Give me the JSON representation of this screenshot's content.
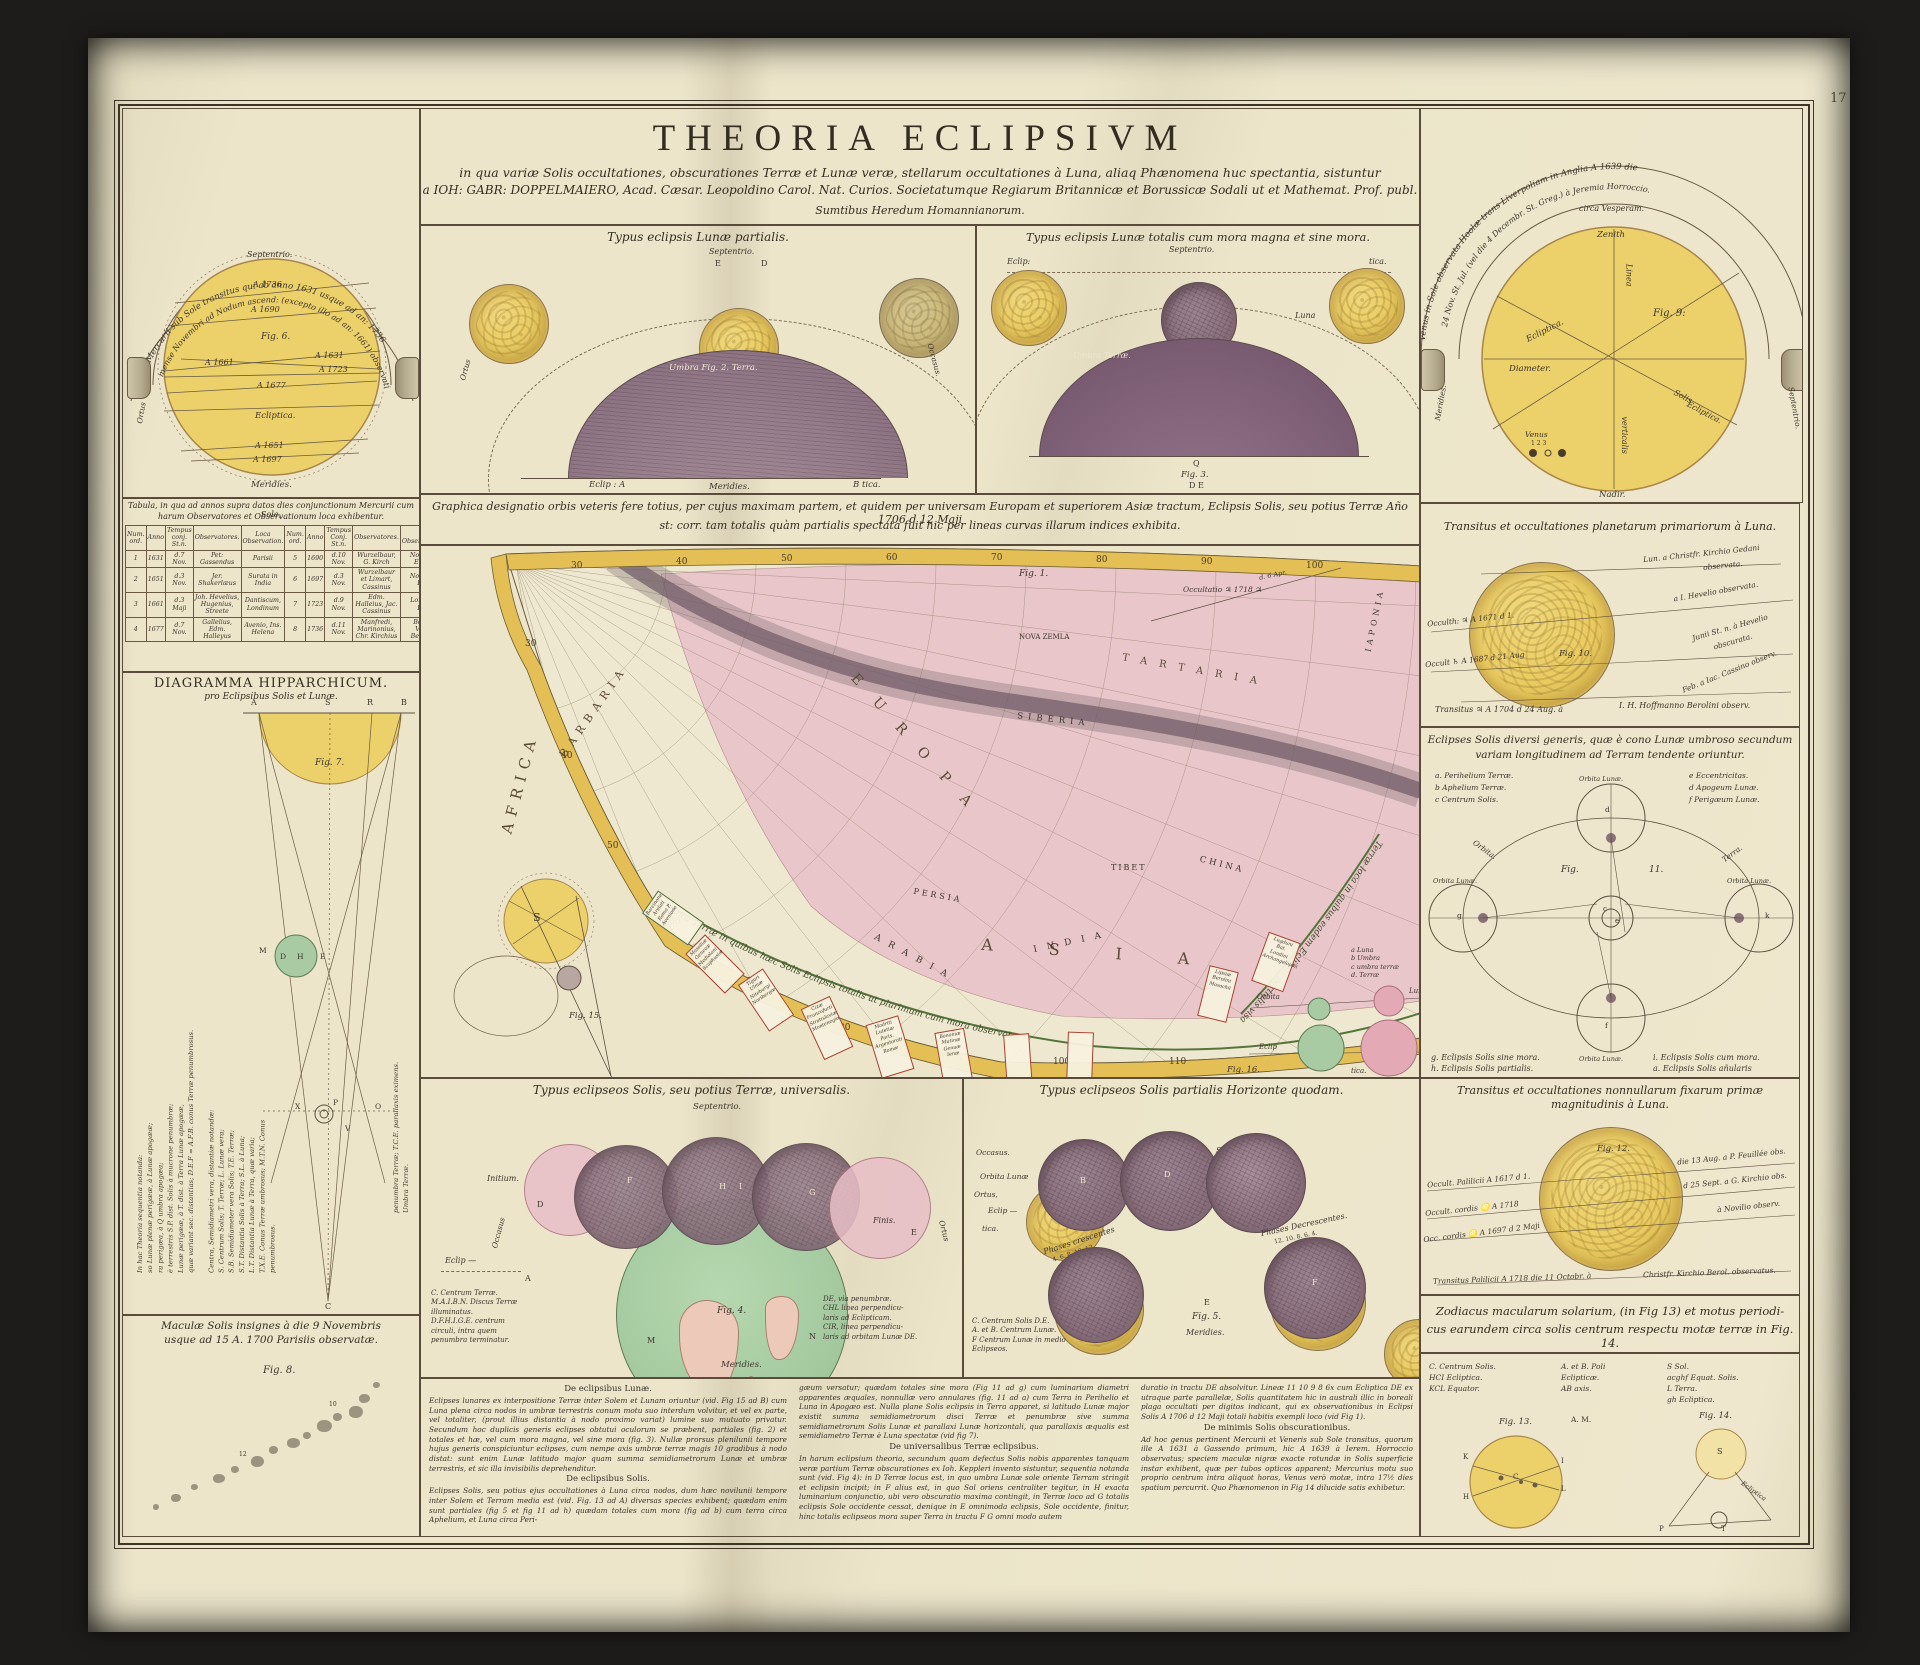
{
  "page": {
    "number": "17"
  },
  "title": {
    "main": "THEORIA ECLIPSIVM",
    "sub1": "in qua variæ Solis occultationes, obscurationes Terræ et Lunæ veræ, stellarum occultationes à Luna, aliaq Phænomena huc spectantia, sistuntur",
    "sub2": "a IOH: GABR: DOPPELMAIERO, Acad. Cæsar. Leopoldino Carol. Nat. Curios. Societatumque Regiarum Britannicæ et Borussicæ Sodali ut et Mathemat. Prof. publ.",
    "sub3": "Sumtibus Heredum Homannianorum."
  },
  "mercury": {
    "arc1": "Octo Mercurii sub Sole transitus qui ab anno 1631 usque ad an: 1736",
    "arc2": "mense Novembri ad Nodum ascend: (excepto illo ad an: 1661) observati.",
    "septentrio": "Septentrio.",
    "meridies": "Meridies.",
    "ortus": "Ortus",
    "fig": "Fig. 6.",
    "ecliptica": "Ecliptica.",
    "years": {
      "a1736": "A 1736",
      "a1690": "A 1690",
      "a1661": "A 1661",
      "a1631": "A 1631",
      "a1723": "A 1723",
      "a1677": "A 1677",
      "a1651": "A 1651",
      "a1697": "A 1697"
    }
  },
  "lunar_partial": {
    "header": "Typus eclipsis Lunæ partialis.",
    "septentrio": "Septentrio.",
    "e": "E",
    "d": "D",
    "umbra": "Umbra  Fig. 2.  Terra.",
    "eclip_a": "Eclip : A",
    "b_tica": "B tica.",
    "meridies": "Meridies.",
    "ortus": "Ortus",
    "occasus": "Occasus."
  },
  "lunar_total": {
    "header": "Typus eclipsis Lunæ totalis cum mora magna et sine mora.",
    "septentrio": "Septentrio.",
    "umbra": "Umbra Terræ.",
    "eclip": "Eclip:",
    "tica": "tica.",
    "luna": "Luna",
    "q": "Q",
    "fig": "Fig. 3.",
    "de": "D  E"
  },
  "venus": {
    "arc1": "Venus in Sole observata Hoolæ trans Liverpoliam in Anglia A 1639 die",
    "arc2": "24 Nov. St. Jul. (vel die 4 Decembr. St. Greg.) à Jeremia Horroccio.",
    "vesperam": "circa Vesperam.",
    "zenith": "Zenith",
    "linea": "Linea",
    "verticalis": "verticalis",
    "ecliptica": "Ecliptica.",
    "diameter": "Diameter.",
    "solis": "Solis",
    "solis_ecl": "Ecliptica.",
    "fig": "Fig. 9:",
    "venus_label": "Venus",
    "digits": "1 2 3",
    "meridies": "Meridies.",
    "septentrio": "Septentrio.",
    "nadir": "Nadir."
  },
  "table": {
    "caption1": "Tabula, in qua ad annos supra datos dies conjunctionum Mercurii cum Sole,",
    "caption2": "harum Observatores et Observationum loca exhibentur.",
    "headers": [
      "Num. ord.",
      "Anno",
      "Tempus conj. St.n.",
      "Observatores.",
      "Loca Observation.",
      "Num. ord.",
      "Anno",
      "Tempus Conj. St.n.",
      "Observatores.",
      "Loca Observationum."
    ],
    "rows": [
      [
        "1",
        "1631",
        "d.7 Nov.",
        "Pet: Gassendus",
        "Parisii",
        "5",
        "1690",
        "d.10 Nov.",
        "Wurzelbaur, G. Kirch",
        "Noriberga, Erfordia"
      ],
      [
        "2",
        "1651",
        "d.3 Nov.",
        "Jer. Shakerlæus",
        "Surata in India",
        "6",
        "1697",
        "d.3 Nov.",
        "Wurzelbaur et Limart, Cassinus",
        "Noriberga, Parisii"
      ],
      [
        "3",
        "1661",
        "d.3 Maji",
        "Joh. Hevelius, Hugenius, Streete",
        "Dantiscum, Londinum",
        "7",
        "1723",
        "d.9 Nov.",
        "Edm. Halleius, Jac. Cassinus",
        "Londinum, Parisii"
      ],
      [
        "4",
        "1677",
        "d.7 Nov.",
        "Gallelius, Edm. Halleyus",
        "Avenio, Ins. Helena",
        "8",
        "1736",
        "d.11 Nov.",
        "Manfredi, Marinonius, Chr. Kirchius",
        "Bononia, Vienna, Berolinum"
      ]
    ]
  },
  "hipparchic": {
    "header": "DIAGRAMMA HIPPARCHICUM.",
    "subheader": "pro Eclipsibus Solis et Lunæ.",
    "fig": "Fig. 7.",
    "a": "A",
    "s": "S",
    "r": "R",
    "b": "B",
    "c": "C",
    "m": "M",
    "d": "D",
    "h": "H",
    "e": "E",
    "x": "X",
    "p": "P",
    "o": "O",
    "v": "V",
    "left_text": "In hac Theoria sequentia notanda:\nso Lunæ plenæ perigææ, à Lunæ apogææ;\nra perigæa, à Q umbra apogæa;\nè terrestris S.P. dist. Solis à mucrone penumbræ;\nLunæ perigææ, à T. dist. à Terra Lunæ apogææ,\nquæ variant sec. distantias; D.E.F = A.F.B. conus Terræ penumbrosus.\n\nCentra, Semidiametri vera, distantiæ notandæ:\nS. Centrum Solis; T. Terræ; L. Lunæ vera;\nS.B. Semidiameter vera Solis; T.E. Terræ;\nS.T. Distantia Solis à Terra; S.L. à Luna;\nL.T. Distantia Lunæ à Terra, quæ varia;\nT.X.E. Conus Terræ umbrosus; M.T.N. Conus\npenumbrosus.",
    "right_text": "penumbra Terræ; T.C.E. parallaxis eximens.\nUmbra Terræ."
  },
  "maculae": {
    "caption1": "Maculæ Solis insignes à die 9 Novembris",
    "caption2": "usque ad 15 A. 1700 Parisiis observatæ.",
    "fig": "Fig. 8.",
    "n10": "10",
    "n12": "12"
  },
  "map": {
    "caption1": "Graphica designatio orbis veteris fere totius, per cujus maximam partem, et quidem per universam Europam et superiorem Asiæ tractum, Eclipsis Solis, seu potius Terræ Año 1706 d 12 Maji",
    "caption2": "st: corr. tam totalis quàm partialis spectata fuit hic per lineas curvas illarum indices exhibita.",
    "fig1": "Fig. 1.",
    "fig15": "Fig. 15.",
    "fig16": "Fig. 16.",
    "labels": {
      "africa": "AFRICA",
      "barbaria": "BARBARIA",
      "europa": "EUROPA",
      "asia": "ASIA",
      "tartaria": "TARTARIA",
      "nova_zemla": "NOVA ZEMLA",
      "siberia": "SIBERIA",
      "china": "CHINA",
      "tibet": "TIBET",
      "india": "INDIA",
      "persia": "PERSIA",
      "arabia": "ARABIA",
      "iaponia": "IAPONIA",
      "s": "S"
    },
    "occ_note": "Occultatio ♃ 1718 ♃",
    "occ_note2": "d. 6 Apr.",
    "band_total": "Loca Terræ in quibus hæc Solis Eclipsis totalis ut plurimum cum mora observata.",
    "band_partial": "Terræ loca in quibus eadem Eclipsis partialis visa.",
    "deg_top": [
      "30",
      "40",
      "50",
      "60",
      "70",
      "80",
      "90",
      "100"
    ],
    "deg_in": [
      "30",
      "40",
      "50",
      "60",
      "70",
      "80",
      "90",
      "100",
      "110"
    ],
    "legend_abcd": "a Luna\nb Umbra\nc umbra terræ\nd. Terræ",
    "orbita": "Orbita",
    "lun": "Lun.",
    "eclip": "Eclip",
    "tica": "tica.",
    "boxes": {
      "t1": "Barcinone\nArelati\nRoma P.\nAvenione",
      "t2": "Massiliæ\nGenevæ\nMediolani\nScaphusiæ",
      "t3": "Tiguri\nUlmæ\nNiteburgi\nNoribergæ",
      "t4": "Cizæ\nFrancofurti\nStratislaviæ\nMontenegio",
      "t5": "Madriti\nLutetiæ Paris.\nArgentorati\nRomæ",
      "t6": "Bononiæ\nMutinæ\nGenuæ\nIenæ",
      "p1": "Lipsiæ\nBerolini\nMosochii",
      "p2": "Lugduni Bat.\nLondini\nArchangelopoli"
    }
  },
  "universal": {
    "header": "Typus eclipseos Solis, seu potius Terræ, universalis.",
    "septentrio": "Septentrio.",
    "initium": "Initium.",
    "finis": "Finis.",
    "occasus": "Occasus",
    "ortus": "Ortus",
    "eclip": "Eclip —",
    "a": "A",
    "d": "D",
    "f": "F",
    "h": "H",
    "i": "I",
    "g": "G",
    "e": "E",
    "m": "M",
    "n": "N",
    "fig": "Fig. 4.",
    "meridies": "Meridies.",
    "legend1": "C. Centrum Terræ.\nM.A.I.B.N. Discus Terræ\nilluminatus.\nD.F.H.I.G.E. centrum\ncirculi, intra quem\npenumbra terminatur.",
    "legend2": "DE, via penumbræ.\nCHL linea perpendicu-\nlaris ad Eclipticam.\nCIR, linea perpendicu-\nlaris ad orbitam Lunæ DE."
  },
  "horizon": {
    "header": "Typus eclipseos Solis partialis Horizonte quodam.",
    "septentrio": "Septentrio.",
    "orbita": "Orbita Lunæ",
    "ortus": "Ortus,",
    "eclip": "Eclip —",
    "occasus": "Occasus.",
    "tica": "tica.",
    "crescentes": "Phases crescentes",
    "decrescentes": "Phases Decrescentes.",
    "digits1": "4. 6. 8. 10. 12",
    "digits2": "12. 10. 8. 6. 4.",
    "fig": "Fig. 5.",
    "e": "E",
    "d": "D",
    "b": "B",
    "f": "F",
    "meridies": "Meridies.",
    "legend": "C. Centrum Solis D.E.\nA. et B. Centrum Lunæ.\nF Centrum Lunæ in medio\nEclipseos."
  },
  "planet_occ": {
    "header": "Transitus et occultationes planetarum primariorum à Luna.",
    "fig": "Fig. 10.",
    "l1": "Occulth: ♃ A 1671 d 1.",
    "l2": "Occult ♄ A 1687 d 21 Aug",
    "r1": "Lun. a Christfr. Kirchio Gedani",
    "r1b": "observata.",
    "r2": "a I. Hevelio observata.",
    "r3": "Junii St. n. à Hevelio",
    "r3b": "obscurata.",
    "r4": "Feb. a Iac. Cassino observ.",
    "bottom1": "Transitus ♃ A 1704 d 24 Aug. à",
    "bottom2": "I. H. Hoffmanno Berolini observ."
  },
  "solar_types": {
    "header1": "Eclipses Solis diversi generis, quæ è cono Lunæ umbroso secundum",
    "header2": "variam longitudinem ad Terram tendente oriuntur.",
    "leg_a": "a. Perihelium Terræ.",
    "leg_b": "b Aphelium Terræ.",
    "leg_c": "c Centrum Solis.",
    "leg_e": "e Eccentricitas.",
    "leg_d": "d Apogeum Lunæ.",
    "leg_f": "f Perigæum Lunæ.",
    "fig": "Fig.",
    "fig_n": "11.",
    "orbita": "Orbita.",
    "terra": "Terra.",
    "orb1": "Orbita Lunæ.",
    "orb2": "Orbita Lunæ.",
    "orb3": "Orbita Lunæ.",
    "orb4": "Orbita Lunæ.",
    "cap1": "g. Eclipsis Solis sine mora.",
    "cap2": "h. Eclipsis Solis partialis.",
    "cap3": "i. Eclipsis Solis cum mora.",
    "cap4": "a. Eclipsis Solis añularis",
    "lg": "g",
    "lk": "k",
    "lf": "f",
    "ld": "d",
    "lc": "c",
    "le": "e"
  },
  "star_occ": {
    "header1": "Transitus et occultationes nonnullarum fixarum primæ",
    "header2": "magnitudinis à Luna.",
    "fig": "Fig. 12.",
    "l1": "Occult. Palilicii A 1617 d 1.",
    "l2": "Occult. cordis ♌ A 1718",
    "l3": "Occ. cordis ♌ A 1697 d 2 Maji",
    "r1": "die 13 Aug. a P. Feuillée obs.",
    "r2": "d 25 Sept. a G. Kirchio obs.",
    "r3": "à Novilio observ.",
    "bottom1": "Transitus Palilicii A 1718 die 11 Octobr. à",
    "bottom2": "Christfr. Kirchio Berol. observatus."
  },
  "zodiacus": {
    "header1": "Zodiacus macularum solarium, (in Fig 13) et motus periodi-",
    "header2": "cus earundem circa solis centrum respectu motæ terræ in Fig. 14.",
    "leg1": "C. Centrum Solis.\nHCI Ecliptica.\nKCL Equator.",
    "leg2": "A. et B. Poli\nEclipticæ.\nAB axis.",
    "leg3": "S Sol.\nacghf Equat. Solis.\nL Terra.\ngh Ecliptica.",
    "am": "A. M.",
    "fig13": "Fig. 13.",
    "fig14": "Fig. 14.",
    "k": "K",
    "c": "C",
    "l": "L",
    "h": "H",
    "i": "I",
    "s": "S",
    "p": "P",
    "t": "T",
    "ecl": "Ecliptica"
  },
  "texts": {
    "h_lunae": "De eclipsibus Lunæ.",
    "p_lunae": "Eclipses lunares ex interpositione Terræ inter Solem et Lunam oriuntur (vid. Fig 15 ad B) cum Luna plena circa nodos in umbræ terrestris conum motu suo interdum volvitur, et vel ex parte, vel totaliter, (prout illius distantia à nodo proximo variat) lumine suo mutuato privatur. Secundum hoc duplicis generis eclipses obtutui oculorum se præbent, partiales (fig. 2) et totales et hæ, vel cum mora magna, vel sine mora (fig. 3). Nullæ prorsus plenilunii tempore hujus generis conspiciuntur eclipses, cum nempe axis umbræ terræ magis 10 gradibus à nodo distat: sunt enim Lunæ latitudo major quam summa semidiametrorum Lunæ et umbræ terrestris, et sic illa invisibilis deprehenditur.",
    "h_solis": "De eclipsibus Solis.",
    "p_solis": "Eclipses Solis, seu potius ejus occultationes à Luna circa nodos, dum hæc novilunii tempore inter Solem et Terram media est (vid. Fig. 13 ad A) diversas species exhibent; quædam enim sunt partiales (fig 5 et fig 11 ad h) quædam totales cum mora (fig ad b) cum terra circa Aphelium, et Luna circa Peri-",
    "p_univ_pre": "gæum versatur; quædam totales sine mora (Fig 11 ad g) cum luminarium diametri apparentes æquales, nonnullæ vero annulares (fig. 11 ad a) cum Terra in Perihelio et Luna in Apogæo est. Nulla plane Solis eclipsis in Terra apparet, si latitudo Lunæ major existit summa semidiametrorum disci Terræ et penumbræ sive summa semidiametrorum Solis Lunæ et parallaxi Lunæ horizontali, qua parallaxis æqualis est semidiametro Terræ è Luna spectatæ (vid fig 7).",
    "h_univ": "De universalibus Terræ eclipsibus.",
    "p_univ": "In harum eclipsium theoria, secundum quam defectus Solis nobis apparentes tanquam veræ partium Terræ obscurationes ex Ioh. Keppleri invento sistuntur, sequentia notanda sunt (vid. Fig 4): in D Terræ locus est, in quo umbra Lunæ sole oriente Terram stringit et eclipsin incipit; in F alius est, in quo Sol oriens centraliter tegitur, in H exacta luminarium conjunctio, ubi vero obscuratio maxima contingit, in Terræ loco ad G totalis eclipsis Sole occidente cessat, denique in E omnimoda eclipsis, Sole occidente, finitur, hinc totalis eclipseos mora super Terra in tractu F G omni modo autem",
    "p_min_pre": "duratio in tractu DE absolvitur. Lineæ 11 10 9 8 6x cum Ecliptica DE ex utraque parte parallelæ, Solis quantitatem hic in australi illic in boreali plaga occultati per digitos indicant, qui ex observationibus in Eclipsi Solis A 1706 d 12 Maji totali habitis exempli loco (vid Fig 1).",
    "h_min": "De minimis Solis obscurationibus.",
    "p_min": "Ad hoc genus pertinent Mercurii et Veneris sub Sole transitus, quorum ille A 1631 à Gassendo primum, hic A 1639 à Ierem. Horroccio observatus; speciem maculæ nigræ exacte rotundæ in Solis superficie instar exhibent, quæ per tubos opticos apparent; Mercurius motu suo proprio centrum intra aliquot horas, Venus verò motæ, intra 17½ dies spatium percurrit. Quo Phænomenon in Fig 14 dilucide satis exhibetur."
  }
}
